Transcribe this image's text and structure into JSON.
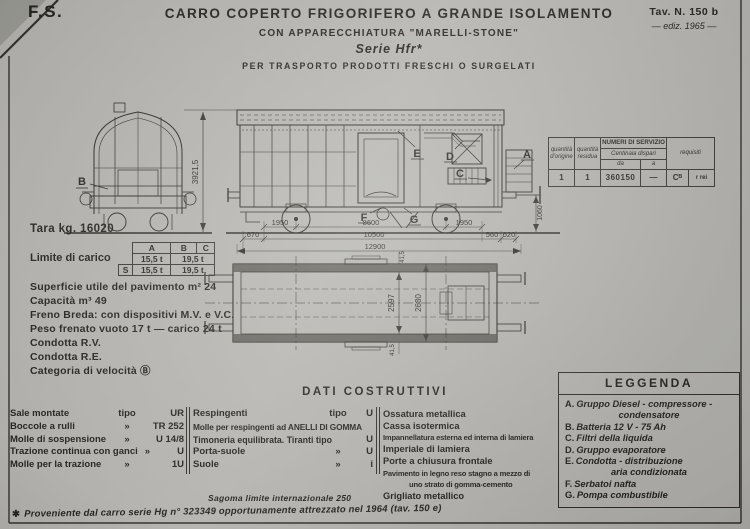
{
  "header": {
    "org_mark": "F.S.",
    "title": "CARRO COPERTO FRIGORIFERO A GRANDE ISOLAMENTO",
    "apparatus_line": "CON APPARECCHIATURA \"MARELLI-STONE\"",
    "series_line": "Serie Hfr*",
    "purpose_line": "PER TRASPORTO PRODOTTI FRESCHI O SURGELATI",
    "sheet_number": "Tav. N. 150 b",
    "edition": "— ediz. 1965 —"
  },
  "service_table": {
    "col_quantita_origine": "quantità d'origine",
    "col_quantita_residua": "quantità residua",
    "col_numeri_servizio": "NUMERI DI SERVIZIO",
    "col_centinaia_dispari": "Centinaia dispari",
    "col_da": "da",
    "col_a": "a",
    "col_requisiti": "requisiti",
    "row": {
      "quantita_origine": "1",
      "quantita_residua": "1",
      "da": "360150",
      "a": "—",
      "requisiti_1": "Cᴮ",
      "requisiti_2": "r rei"
    }
  },
  "drawing": {
    "labels": {
      "A": "A",
      "B": "B",
      "C": "C",
      "D": "D",
      "E": "E",
      "F": "F",
      "G": "G"
    },
    "dimensions": {
      "overall_height": "3921,5",
      "buffer_height": "1060",
      "axle_to_end_left": "1950",
      "wheelbase": "8600",
      "axle_to_end_right": "1950",
      "overhang_left": "670",
      "body_length": "10500",
      "dim_560": "560",
      "dim_620": "620",
      "length_over_buffers": "12900",
      "plan_inner_width": "2597",
      "plan_outer_width": "2680",
      "wall_thickness_top": "41,5",
      "wall_thickness_bottom": "41,5"
    }
  },
  "specs": {
    "tara": "Tara kg. 16020",
    "limite_label": "Limite di carico",
    "limite_table": {
      "headers": [
        "A",
        "B",
        "C"
      ],
      "row1": {
        "a": "15,5 t",
        "bc": "19,5 t"
      },
      "row2_prefix": "S",
      "row2": {
        "a": "15,5 t",
        "bc": "19,5 t"
      }
    },
    "lines": [
      "Superficie utile del pavimento m² 24",
      "Capacità m³ 49",
      "Freno Breda: con dispositivi M.V. e V.C.",
      "Peso frenato vuoto 17 t  — carico 24 t",
      "Condotta R.V.",
      "Condotta R.E.",
      "Categoria di velocità Ⓑ"
    ]
  },
  "dati_costruttivi": {
    "title": "DATI COSTRUTTIVI",
    "col1": [
      {
        "label": "Sale montate",
        "tipo": "tipo",
        "value": "UR"
      },
      {
        "label": "Boccole a rulli",
        "tipo": "»",
        "value": "TR 252"
      },
      {
        "label": "Molle di sospensione",
        "tipo": "»",
        "value": "U 14/8"
      },
      {
        "label": "Trazione continua con ganci",
        "tipo": "»",
        "value": "U"
      },
      {
        "label": "Molle per la trazione",
        "tipo": "»",
        "value": "1U"
      }
    ],
    "col2": [
      {
        "label": "Respingenti",
        "tipo": "tipo",
        "value": "U"
      },
      {
        "label": "Molle per respingenti ad ANELLI DI GOMMA",
        "tipo": "",
        "value": ""
      },
      {
        "label": "Timoneria equilibrata. Tiranti tipo",
        "tipo": "",
        "value": "U"
      },
      {
        "label": "Porta-suole",
        "tipo": "»",
        "value": "U"
      },
      {
        "label": "Suole",
        "tipo": "»",
        "value": "i"
      }
    ],
    "col3": [
      "Ossatura metallica",
      "Cassa isotermica",
      "Impannellatura esterna ed interna di lamiera",
      "Imperiale di lamiera",
      "Porte a chiusura frontale",
      "Pavimento in legno reso stagno a mezzo di",
      "uno strato di gomma-cemento",
      "Grigliato metallico"
    ],
    "sagoma_note": "Sagoma limite internazionale 250"
  },
  "leggenda": {
    "title": "LEGGENDA",
    "items": [
      {
        "key": "A.",
        "lines": [
          "Gruppo Diesel - compressore -",
          "condensatore"
        ]
      },
      {
        "key": "B.",
        "lines": [
          "Batteria 12 V - 75 Ah"
        ]
      },
      {
        "key": "C.",
        "lines": [
          "Filtri della liquida"
        ]
      },
      {
        "key": "D.",
        "lines": [
          "Gruppo evaporatore"
        ]
      },
      {
        "key": "E.",
        "lines": [
          "Condotta - distribuzione",
          "aria condizionata"
        ]
      },
      {
        "key": "F.",
        "lines": [
          "Serbatoi nafta"
        ]
      },
      {
        "key": "G.",
        "lines": [
          "Pompa combustibile"
        ]
      }
    ]
  },
  "footnote": {
    "mark": "✱",
    "text": "Proveniente dal carro serie Hg n° 323349 opportunamente attrezzato nel 1964 (tav. 150 e)"
  },
  "colors": {
    "paper": "#b3b2ae",
    "ink": "#23221d"
  }
}
